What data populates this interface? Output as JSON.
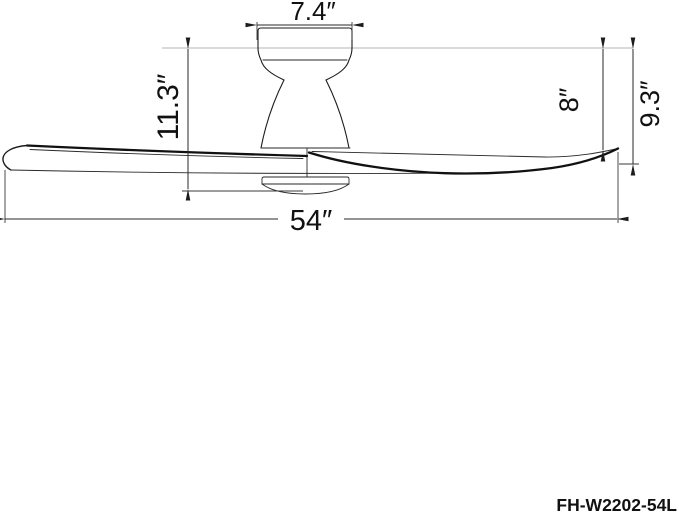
{
  "drawing": {
    "title_hint": "ceiling-fan dimension drawing",
    "model_label": "FH-W2202-54L",
    "labels": {
      "canopy_width": "7.4″",
      "housing_height": "11.3″",
      "ceiling_to_blade_tip_top": "8″",
      "overall_height": "9.3″",
      "blade_sweep": "54″"
    },
    "colors": {
      "outline": "#1c1c1c",
      "dimension_line": "#2a2a2a",
      "ceiling_reference_line": "#b5b5b5",
      "text": "#111111",
      "background": "#ffffff"
    }
  }
}
